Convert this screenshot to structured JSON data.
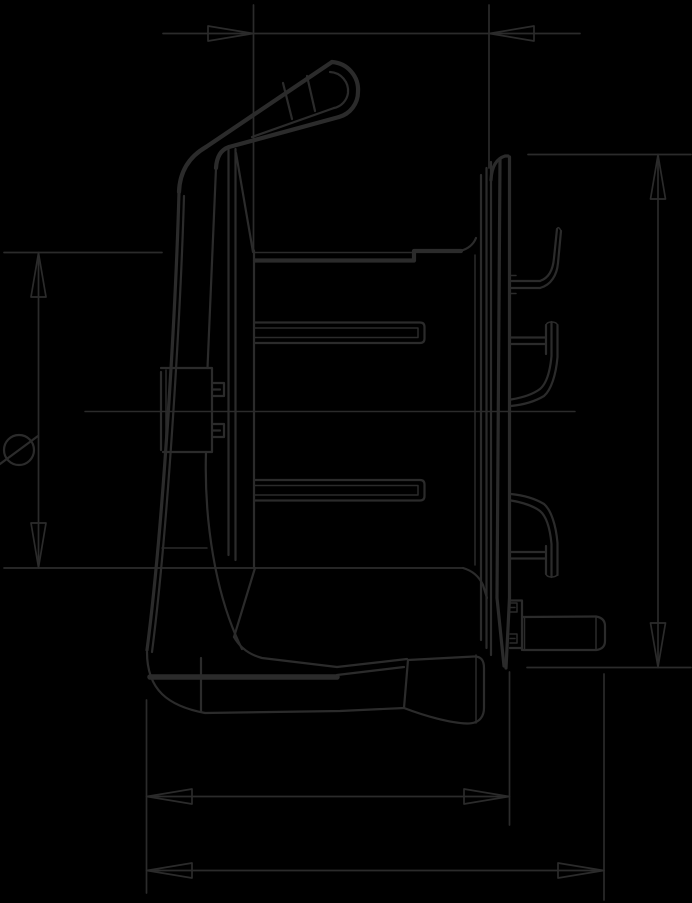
{
  "drawing": {
    "kind": "technical-dimension-drawing",
    "view": "side-view-cable-reel",
    "background_color": "#000000",
    "line_color": "#2b2b2b",
    "diameter_symbol": "⌀",
    "dimension_annotations": [
      {
        "id": "top-width",
        "orientation": "horizontal",
        "label": ""
      },
      {
        "id": "drum-diameter",
        "orientation": "vertical",
        "label": "⌀"
      },
      {
        "id": "flange-height",
        "orientation": "vertical",
        "label": ""
      },
      {
        "id": "base-depth",
        "orientation": "horizontal",
        "label": ""
      },
      {
        "id": "overall-depth",
        "orientation": "horizontal",
        "label": ""
      }
    ]
  }
}
